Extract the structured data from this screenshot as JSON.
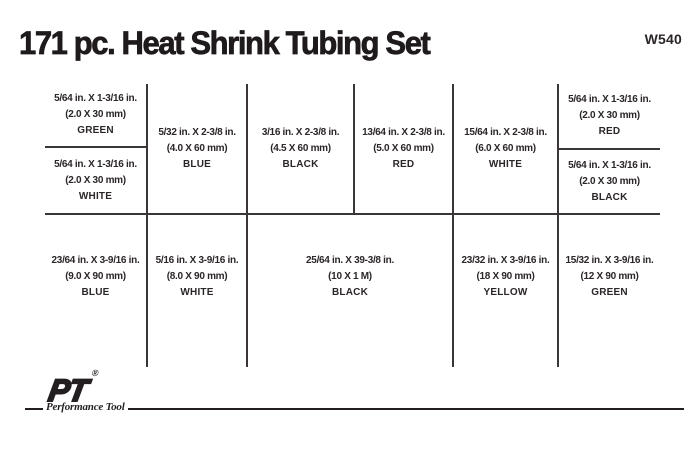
{
  "header": {
    "title": "171 pc. Heat Shrink Tubing Set",
    "model_number": "W540"
  },
  "tray": {
    "top_row": [
      {
        "size_in": "5/64 in. X 1-3/16 in.",
        "size_mm": "(2.0 X 30 mm)",
        "color": "GREEN"
      },
      {
        "size_in": "5/64 in. X 1-3/16 in.",
        "size_mm": "(2.0 X 30 mm)",
        "color": "WHITE"
      },
      {
        "size_in": "5/32 in. X 2-3/8 in.",
        "size_mm": "(4.0 X 60 mm)",
        "color": "BLUE"
      },
      {
        "size_in": "3/16 in. X 2-3/8 in.",
        "size_mm": "(4.5 X 60 mm)",
        "color": "BLACK"
      },
      {
        "size_in": "13/64 in. X 2-3/8 in.",
        "size_mm": "(5.0 X 60 mm)",
        "color": "RED"
      },
      {
        "size_in": "15/64 in. X 2-3/8 in.",
        "size_mm": "(6.0 X 60 mm)",
        "color": "WHITE"
      },
      {
        "size_in": "5/64 in. X 1-3/16 in.",
        "size_mm": "(2.0 X 30 mm)",
        "color": "RED"
      },
      {
        "size_in": "5/64 in. X 1-3/16 in.",
        "size_mm": "(2.0 X 30 mm)",
        "color": "BLACK"
      }
    ],
    "bottom_row": [
      {
        "size_in": "23/64 in. X 3-9/16 in.",
        "size_mm": "(9.0 X 90 mm)",
        "color": "BLUE"
      },
      {
        "size_in": "5/16 in. X 3-9/16 in.",
        "size_mm": "(8.0 X 90 mm)",
        "color": "WHITE"
      },
      {
        "size_in": "25/64 in. X 39-3/8 in.",
        "size_mm": "(10 X 1 M)",
        "color": "BLACK"
      },
      {
        "size_in": "23/32 in. X 3-9/16 in.",
        "size_mm": "(18 X 90 mm)",
        "color": "YELLOW"
      },
      {
        "size_in": "15/32 in. X 3-9/16 in.",
        "size_mm": "(12 X 90 mm)",
        "color": "GREEN"
      }
    ]
  },
  "logo": {
    "brand": "PT",
    "registered_mark": "®",
    "tagline": "Performance Tool"
  },
  "colors": {
    "ink": "#231f20",
    "background": "#ffffff"
  }
}
